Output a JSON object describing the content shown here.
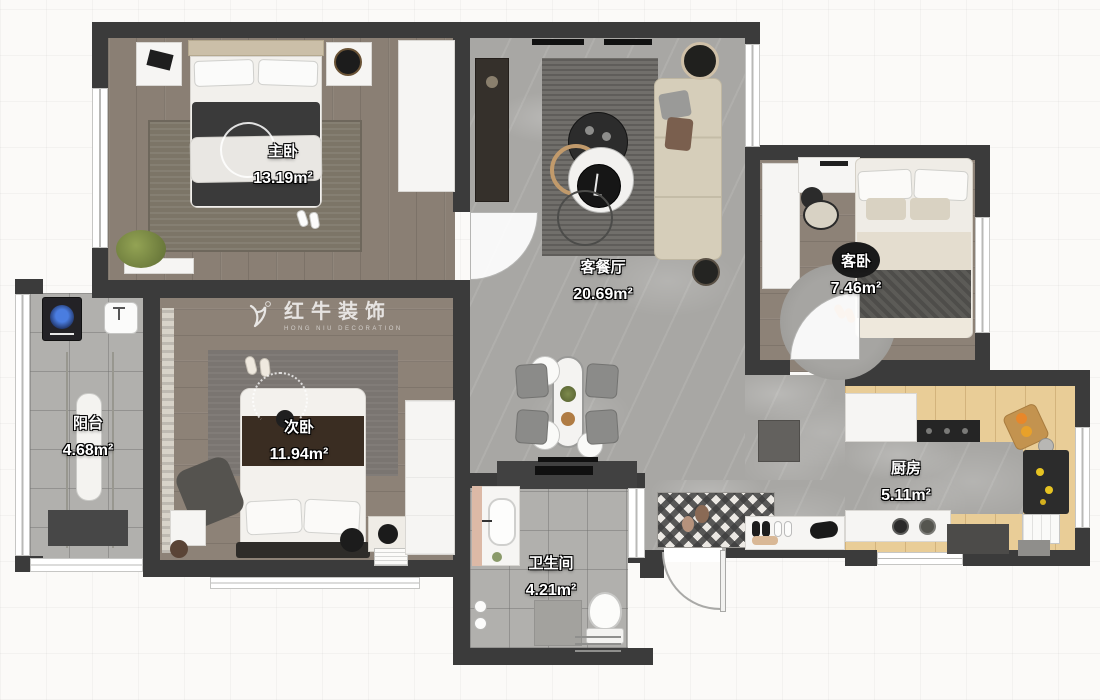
{
  "watermark": {
    "brand": "红牛装饰",
    "subtitle": "HONG NIU DECORATION"
  },
  "rooms": [
    {
      "key": "master-bedroom",
      "name": "主卧",
      "area": "13.19m²"
    },
    {
      "key": "living-dining",
      "name": "客餐厅",
      "area": "20.69m²"
    },
    {
      "key": "guest-bedroom",
      "name": "客卧",
      "area": "7.46m²"
    },
    {
      "key": "second-bedroom",
      "name": "次卧",
      "area": "11.94m²"
    },
    {
      "key": "balcony",
      "name": "阳台",
      "area": "4.68m²"
    },
    {
      "key": "bathroom",
      "name": "卫生间",
      "area": "4.21m²"
    },
    {
      "key": "kitchen",
      "name": "厨房",
      "area": "5.11m²"
    }
  ],
  "colors": {
    "wall": "#3b3b3b",
    "wood_floor": "#8a7f74",
    "marble_floor": "#a8a7a4",
    "tile_floor": "#b1b0ad",
    "kitchen_wood": "#e9cd97"
  }
}
